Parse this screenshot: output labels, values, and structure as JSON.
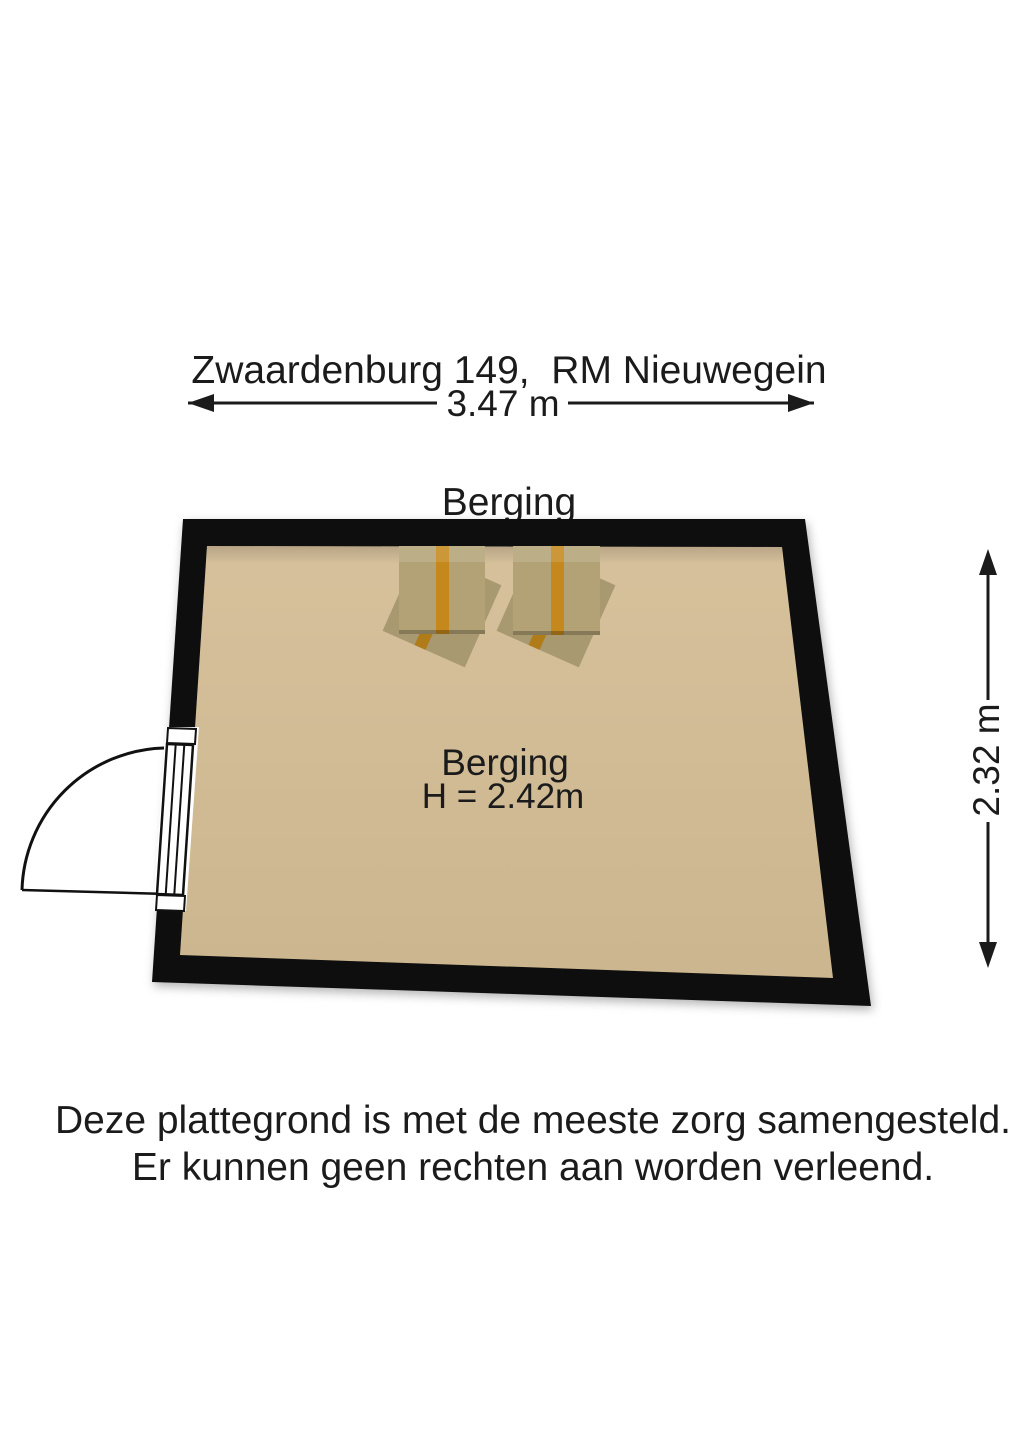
{
  "title": {
    "line1": "Zwaardenburg 149,  RM Nieuwegein",
    "line2": "Berging"
  },
  "dimensions": {
    "width": "3.47 m",
    "height": "2.32 m"
  },
  "room": {
    "name": "Berging",
    "ceiling_height": "H = 2.42m"
  },
  "footer": {
    "line1": "Deze plattegrond is met de meeste zorg samengesteld.",
    "line2": "Er kunnen geen rechten aan worden verleend."
  },
  "colors": {
    "wall": "#0e0e0e",
    "floor_light": "#d7c19c",
    "floor_dark": "#cbb58e",
    "box_top": "#b2a276",
    "box_under": "#a89970",
    "tape": "#c5881c",
    "tape_under": "#b07c1a",
    "dimension_line": "#1b1b1b",
    "text": "#1b1b1b"
  }
}
